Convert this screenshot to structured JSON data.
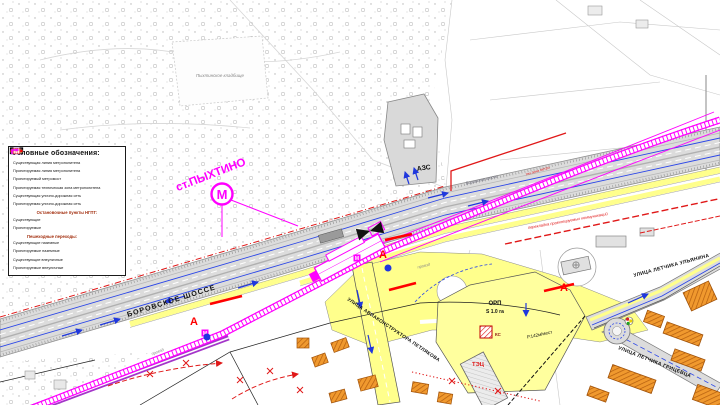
{
  "legend": {
    "title": "Условные обозначения:",
    "items": [
      {
        "icon": "metro-existing-icon",
        "label": "Существующая линия метрополитена"
      },
      {
        "icon": "metro-projected-icon",
        "label": "Проектируемая линия метрополитена"
      },
      {
        "icon": "metro-bridge-icon",
        "label": "Проектируемый метромост"
      },
      {
        "icon": "metro-techzone-icon",
        "label": "Проектируемая техническая зона метрополитена"
      },
      {
        "icon": "street-existing-icon",
        "label": "Существующая улично-дорожная сеть"
      },
      {
        "icon": "street-projected-icon",
        "label": "Проектируемая улично-дорожная сеть"
      },
      {
        "icon": "stop-existing-icon",
        "label": "Существующие"
      },
      {
        "icon": "stop-projected-icon",
        "label": "Проектируемые"
      },
      {
        "icon": "crossing-exist-ground-icon",
        "label": "Существующие наземные"
      },
      {
        "icon": "crossing-proj-ground-icon",
        "label": "Проектируемые наземные"
      },
      {
        "icon": "crossing-exist-off-icon",
        "label": "Существующие внеуличные"
      },
      {
        "icon": "crossing-proj-off-icon",
        "label": "Проектируемые внеуличные"
      }
    ],
    "sections": {
      "stops": "Остановочные пункты НГПТ:",
      "crossings": "Пешеходные переходы:"
    }
  },
  "map": {
    "station": {
      "label": "ст.ПЫХТИНО",
      "m": "М"
    },
    "labels": {
      "azs": "АЗС",
      "borovskoe": "БОРОВСКОЕ ШОССЕ",
      "borovskoe_small": "Боровское шоссе",
      "petlyakova": "УЛИЦА АВИАКОНСТРУКТОРА ПЕТЛЯКОВА",
      "ulyanina": "УЛИЦА ЛЕТЧИКА УЛЬЯНИНА",
      "gricevca": "УЛИЦА ЛЕТЧИКА ГРИЦЕВЦА",
      "cemetery": "Пыхтинское кладбище",
      "proezd": "проезд",
      "orp": "ОРП",
      "orp_s": "S 1.0 га",
      "parking": "Р.142м/мест",
      "tec": "ТЭЦ",
      "ks": "КС",
      "stop_a": "А",
      "utilities": "перекладка проектируемых коммуникаций",
      "techzone": "тех.зона метро"
    }
  },
  "colors": {
    "metro_line": "#ff00ff",
    "metro_bridge": "#a435c9",
    "projected_road": "#ffff8c",
    "existing_road": "#dcdcdc",
    "stop_projected": "#ff0000",
    "stop_existing": "#000000",
    "traffic_blue": "#2038dd",
    "building_orange": "#f0992e"
  }
}
